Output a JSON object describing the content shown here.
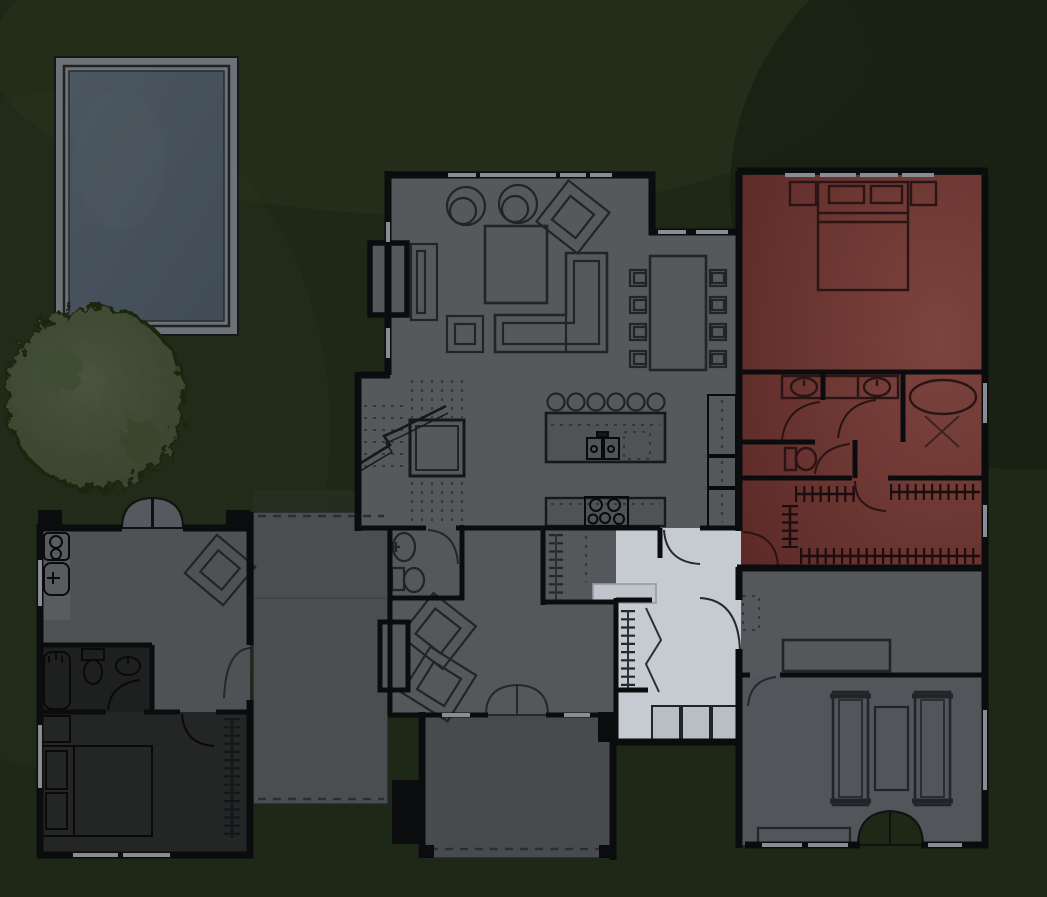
{
  "scene": {
    "type": "house-floorplan-night-overview",
    "width": 1047,
    "height": 897
  },
  "colors": {
    "background": "#1e2817",
    "bg_glow": "#2b351f",
    "bg_shade": "#141c0f",
    "wall": "#0b0c0d",
    "window": "#878d93",
    "pool_deck": "#6d7276",
    "pool_water_hi": "#4b5660",
    "pool_water_lo": "#414c57",
    "tree_hi": "#48543d",
    "tree_lo": "#37422d",
    "exterior_door_leaf": "#565a5e",
    "patio_roof_band": "#272f20"
  },
  "rooms": [
    {
      "id": "great-room",
      "floor": "#55595c",
      "light": "dim"
    },
    {
      "id": "master-suite",
      "floor_hi": "#7d443e",
      "floor_lo": "#5d2a28",
      "light": "red"
    },
    {
      "id": "hall-mudroom-pantry",
      "floor": "#c6cbd1",
      "light": "on"
    },
    {
      "id": "den",
      "floor": "#54585b",
      "light": "dim"
    },
    {
      "id": "powder-room",
      "floor": "#54585b",
      "light": "dim"
    },
    {
      "id": "office",
      "floor": "#54585b",
      "light": "dim"
    },
    {
      "id": "gym",
      "floor": "#52565a",
      "light": "dim"
    },
    {
      "id": "casita",
      "floor": "#4e5255",
      "light": "dim"
    },
    {
      "id": "casita-bathroom",
      "floor": "#1e1f1f",
      "light": "off"
    },
    {
      "id": "casita-bedroom",
      "floor": "#242525",
      "light": "off"
    },
    {
      "id": "patio",
      "floor": "#4a4e51"
    },
    {
      "id": "porch",
      "floor": "#474b4e"
    },
    {
      "id": "stairs",
      "floor": "#54585b"
    },
    {
      "id": "kitchen-counter",
      "floor": "#4f5356"
    },
    {
      "id": "mudroom-cubby",
      "floor": "#b9bec4"
    },
    {
      "id": "pantry-counter",
      "floor": "#c0c5cb"
    },
    {
      "id": "casita-counter",
      "floor": "#585c5f"
    }
  ]
}
